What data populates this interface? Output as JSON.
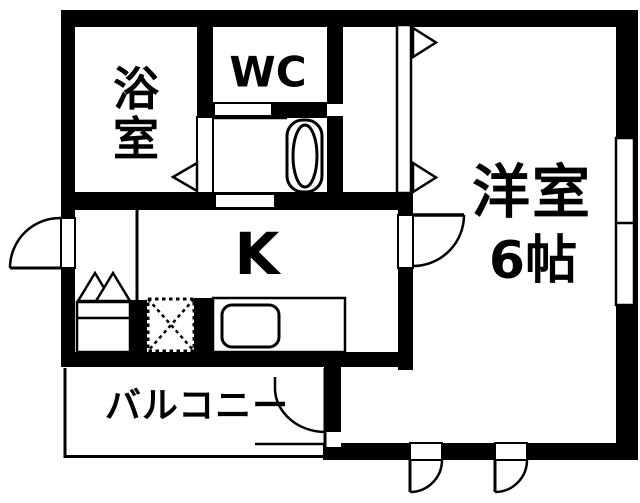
{
  "page": {
    "background": "#ffffff",
    "wall_color": "#000000",
    "line_color": "#000000"
  },
  "floorplan": {
    "rooms": {
      "bathroom": {
        "label": "浴室",
        "label_chars": [
          "浴",
          "室"
        ]
      },
      "wc": {
        "label": "WC"
      },
      "kitchen": {
        "label": "K"
      },
      "western_room": {
        "label": "洋室",
        "size": "6帖"
      },
      "balcony": {
        "label": "バルコニー"
      }
    },
    "symbols": {
      "toilet": "toilet-fixture",
      "sink": "kitchen-sink",
      "refrigerator_space": "dotted-x-square",
      "shoe_cabinet": "double-triangle",
      "entrance": "door-swing-arc"
    }
  }
}
